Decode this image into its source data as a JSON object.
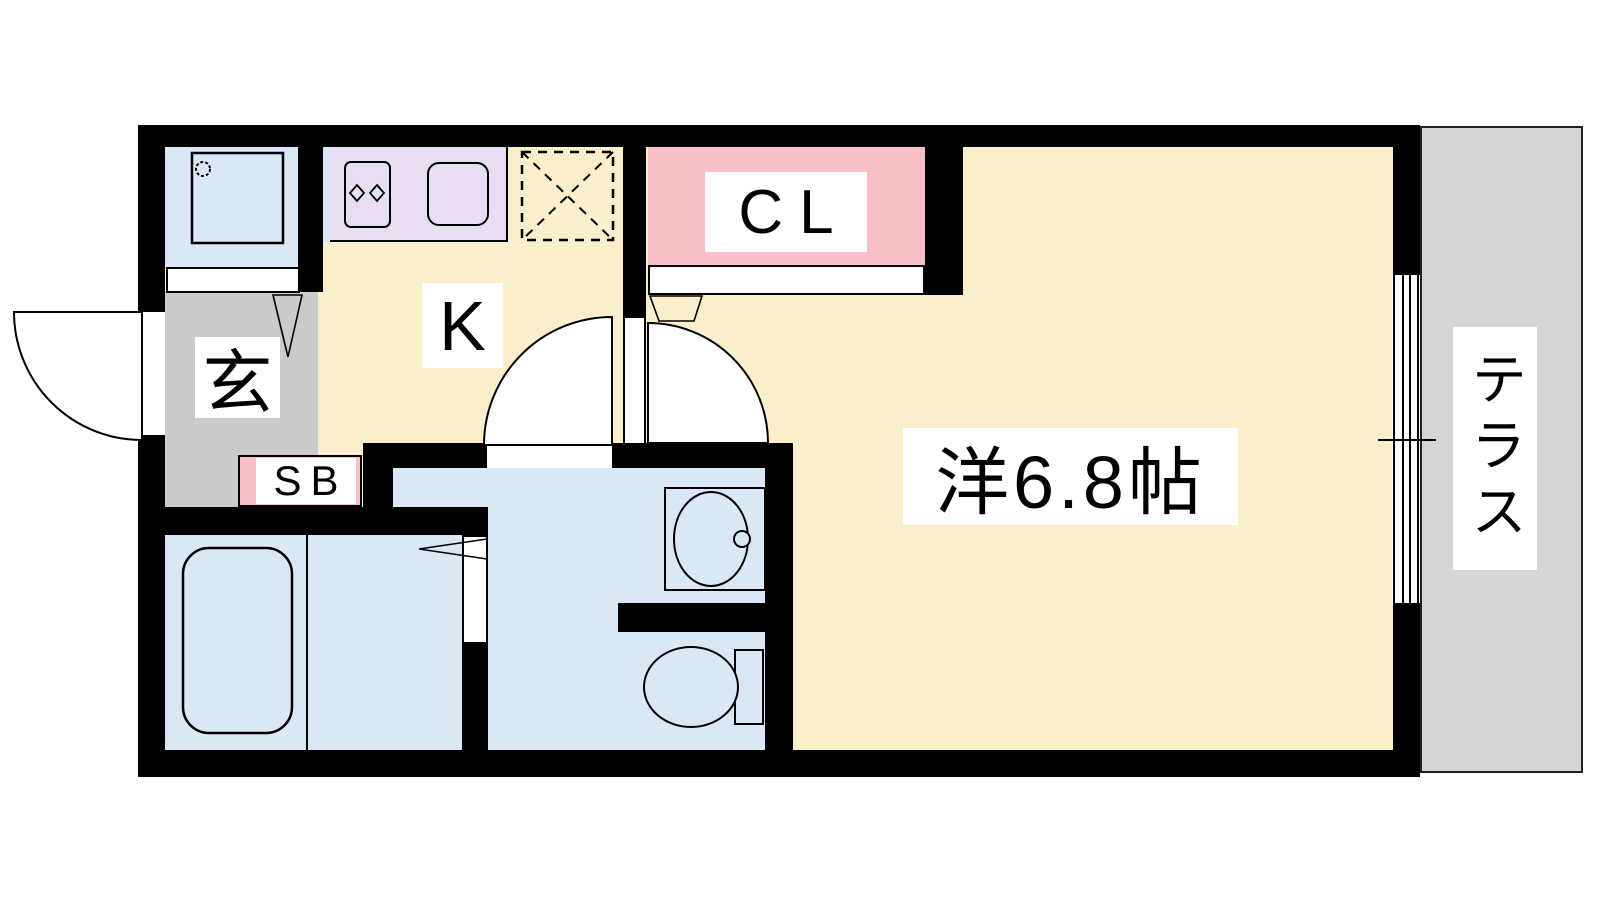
{
  "plan": {
    "type": "apartment-floor-plan",
    "rooms": {
      "entrance": {
        "label": "玄"
      },
      "kitchen": {
        "label": "K"
      },
      "closet": {
        "label": "CL"
      },
      "shoe_box": {
        "label": "SB"
      },
      "western_room": {
        "label": "洋6.8帖"
      },
      "terrace": {
        "label": "テラス"
      }
    },
    "fixtures": {
      "washing_machine": "washing-machine",
      "stove": "two-burner-stove",
      "kitchen_sink": "kitchen-sink",
      "refrigerator_space": "refrigerator-space-dashed-box",
      "bathtub": "bathtub",
      "wash_basin": "wash-basin",
      "toilet": "toilet",
      "window": "sliding-window",
      "doors": "swing-doors"
    },
    "colors": {
      "floor_cream": "#FBEECB",
      "water_blue": "#D9E7F6",
      "counter_purple": "#E8DDF3",
      "closet_pink": "#F9BFC7",
      "genkan_gray": "#CBCBCB",
      "terrace_gray": "#D5D5D5",
      "wall_black": "#000000"
    }
  }
}
